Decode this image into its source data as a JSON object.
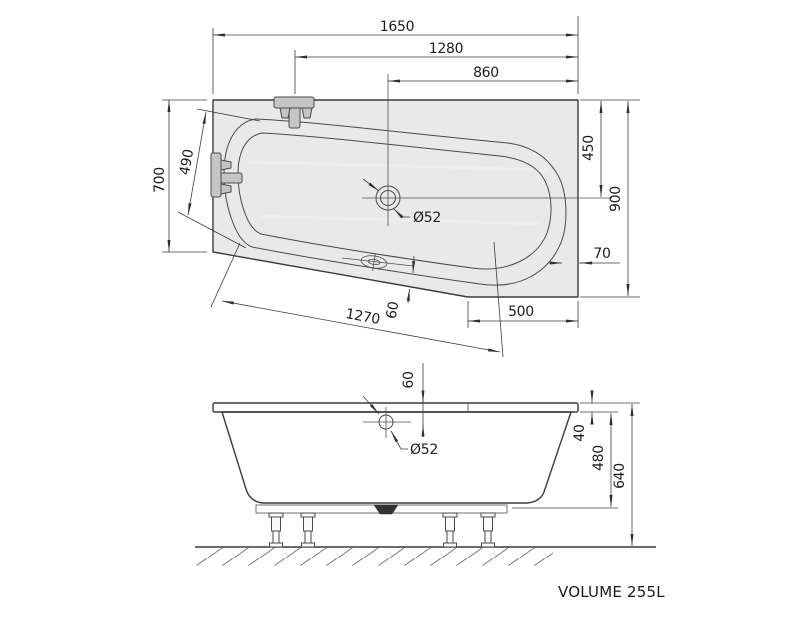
{
  "drawing_type": "bathtub technical dimension drawing",
  "product": {
    "volume_label": "VOLUME 255L"
  },
  "top_view": {
    "dimensions": {
      "overall_length": "1650",
      "length_faucet_to_right": "1280",
      "length_drain_to_right": "860",
      "left_end_width": "700",
      "left_faucet_span": "490",
      "right_top_to_drain_axis": "450",
      "right_end_width": "900",
      "bowl_to_right_edge": "70",
      "front_edge_length": "1270",
      "overflow_to_front_edge": "60",
      "corner_cut_width": "500",
      "drain_diameter": "Ø52"
    }
  },
  "side_view": {
    "dimensions": {
      "rim_to_overflow": "60",
      "overflow_diameter": "Ø52",
      "rim_height": "40",
      "inner_depth": "480",
      "overall_height": "640"
    }
  }
}
